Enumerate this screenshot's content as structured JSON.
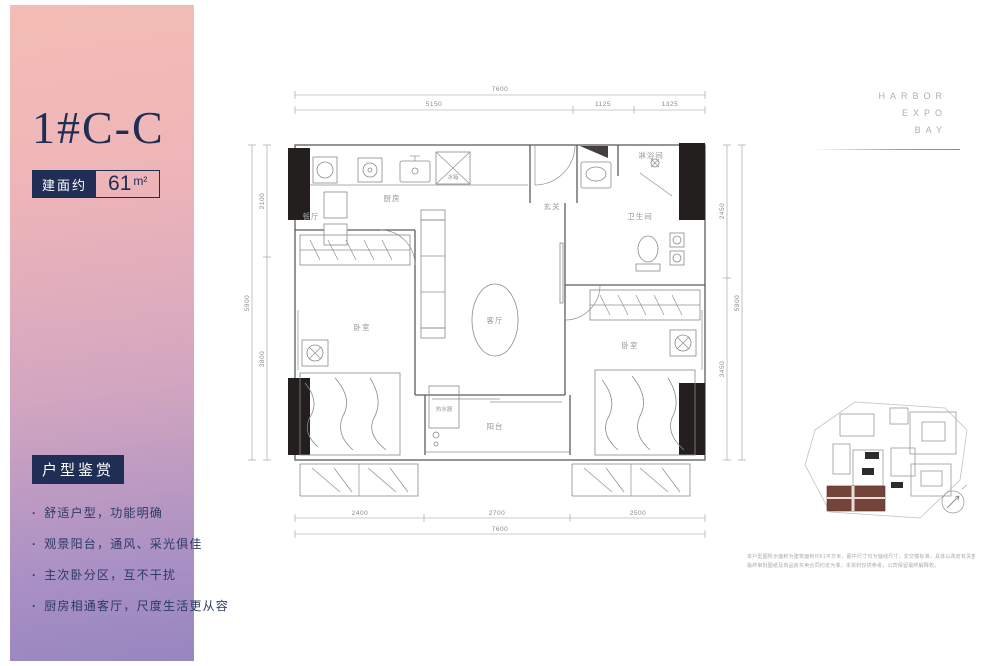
{
  "sidebar": {
    "unit_title": "1#C-C",
    "area_label": "建面约",
    "area_value": "61",
    "area_unit": "m²",
    "features_title": "户型鉴赏",
    "features": [
      "舒适户型，功能明确",
      "观景阳台，通风、采光俱佳",
      "主次卧分区，互不干扰",
      "厨房相通客厅，尺度生活更从容"
    ]
  },
  "brand": {
    "line1": "HARBOR",
    "line2": "EXPO",
    "line3": "BAY"
  },
  "floorplan": {
    "rooms": {
      "dining": "餐厅",
      "kitchen": "厨房",
      "fridge": "冰箱",
      "entry": "玄关",
      "shower": "淋浴间",
      "bathroom": "卫生间",
      "bedroom_left": "卧室",
      "living": "客厅",
      "bedroom_right": "卧室",
      "water_heater": "热水器",
      "balcony": "阳台"
    },
    "dimensions": {
      "top_total": "7600",
      "top_seg1": "5150",
      "top_seg2": "1125",
      "top_seg3": "1325",
      "bottom_seg1": "2400",
      "bottom_seg2": "2700",
      "bottom_seg3": "2500",
      "bottom_total": "7600",
      "left_total": "5900",
      "left_seg1": "2100",
      "left_seg2": "3800",
      "right_seg1": "2450",
      "right_seg2": "3450",
      "right_total": "5900"
    }
  },
  "disclaimer": {
    "line1": "本户型图所示面积为建筑面积约61平方米，图中尺寸均为轴线尺寸，非交楼标准，具体以政府有关部门",
    "line2": "最终审批图纸及商品房买卖合同约定为准。本资料仅供参考，公司保留最终解释权。"
  }
}
